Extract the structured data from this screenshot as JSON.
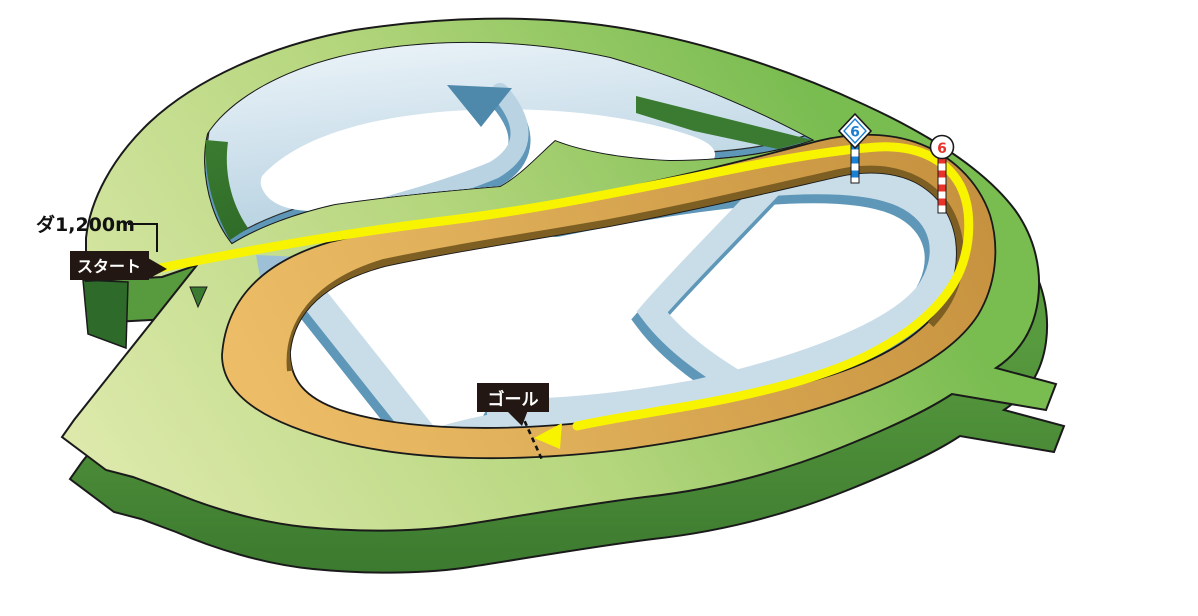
{
  "page": {
    "background": "#ffffff",
    "width": 1198,
    "height": 616
  },
  "course_map": {
    "type": "racecourse-3d-course-diagram",
    "distance_label": "ダ1,200m",
    "start_label": "スタート",
    "goal_label": "ゴール",
    "race_path_color": "#f8f400",
    "label_box_color": "#221712",
    "surfaces": [
      {
        "name": "turf-course",
        "color": "#8fc75f"
      },
      {
        "name": "dirt-course",
        "color": "#d9a64e"
      },
      {
        "name": "steeplechase-course",
        "color": "#c6dcea"
      }
    ],
    "furlong_markers": [
      {
        "id": "blue-diamond-pole",
        "shape": "diamond",
        "value": "6",
        "color": "#1b7fd2",
        "pole_style": "blue-white striped"
      },
      {
        "id": "red-circle-pole",
        "shape": "circle",
        "value": "6",
        "color": "#e8332a",
        "pole_style": "red-white striped"
      }
    ]
  }
}
